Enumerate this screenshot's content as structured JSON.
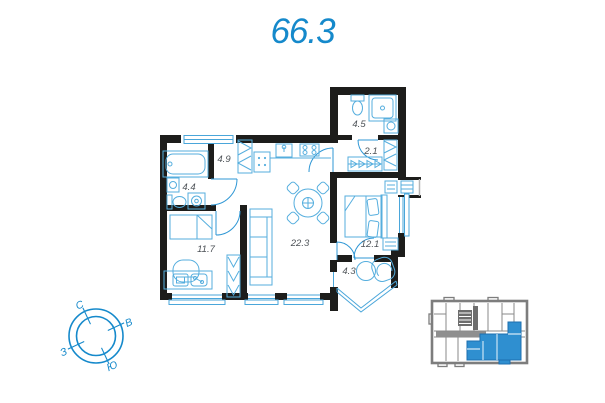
{
  "title": "66.3",
  "plan": {
    "rooms": [
      {
        "id": "bathroom-top",
        "area": "4.5"
      },
      {
        "id": "closet",
        "area": "2.1"
      },
      {
        "id": "hallway",
        "area": "4.9"
      },
      {
        "id": "bathroom-left",
        "area": "4.4"
      },
      {
        "id": "bedroom-left",
        "area": "11.7"
      },
      {
        "id": "living-kitchen",
        "area": "22.3"
      },
      {
        "id": "bedroom-right",
        "area": "12.1"
      },
      {
        "id": "balcony",
        "area": "4.3"
      }
    ]
  },
  "compass": {
    "north": "С",
    "east": "В",
    "west": "З",
    "south": "Ю"
  },
  "colors": {
    "accent": "#1589cb",
    "walls": "#1d1d1b",
    "fixtures": "#55aede",
    "room_label": "#4d5257",
    "keyplan_walls": "#7d7d7d",
    "keyplan_highlight": "#2f8fd0"
  }
}
